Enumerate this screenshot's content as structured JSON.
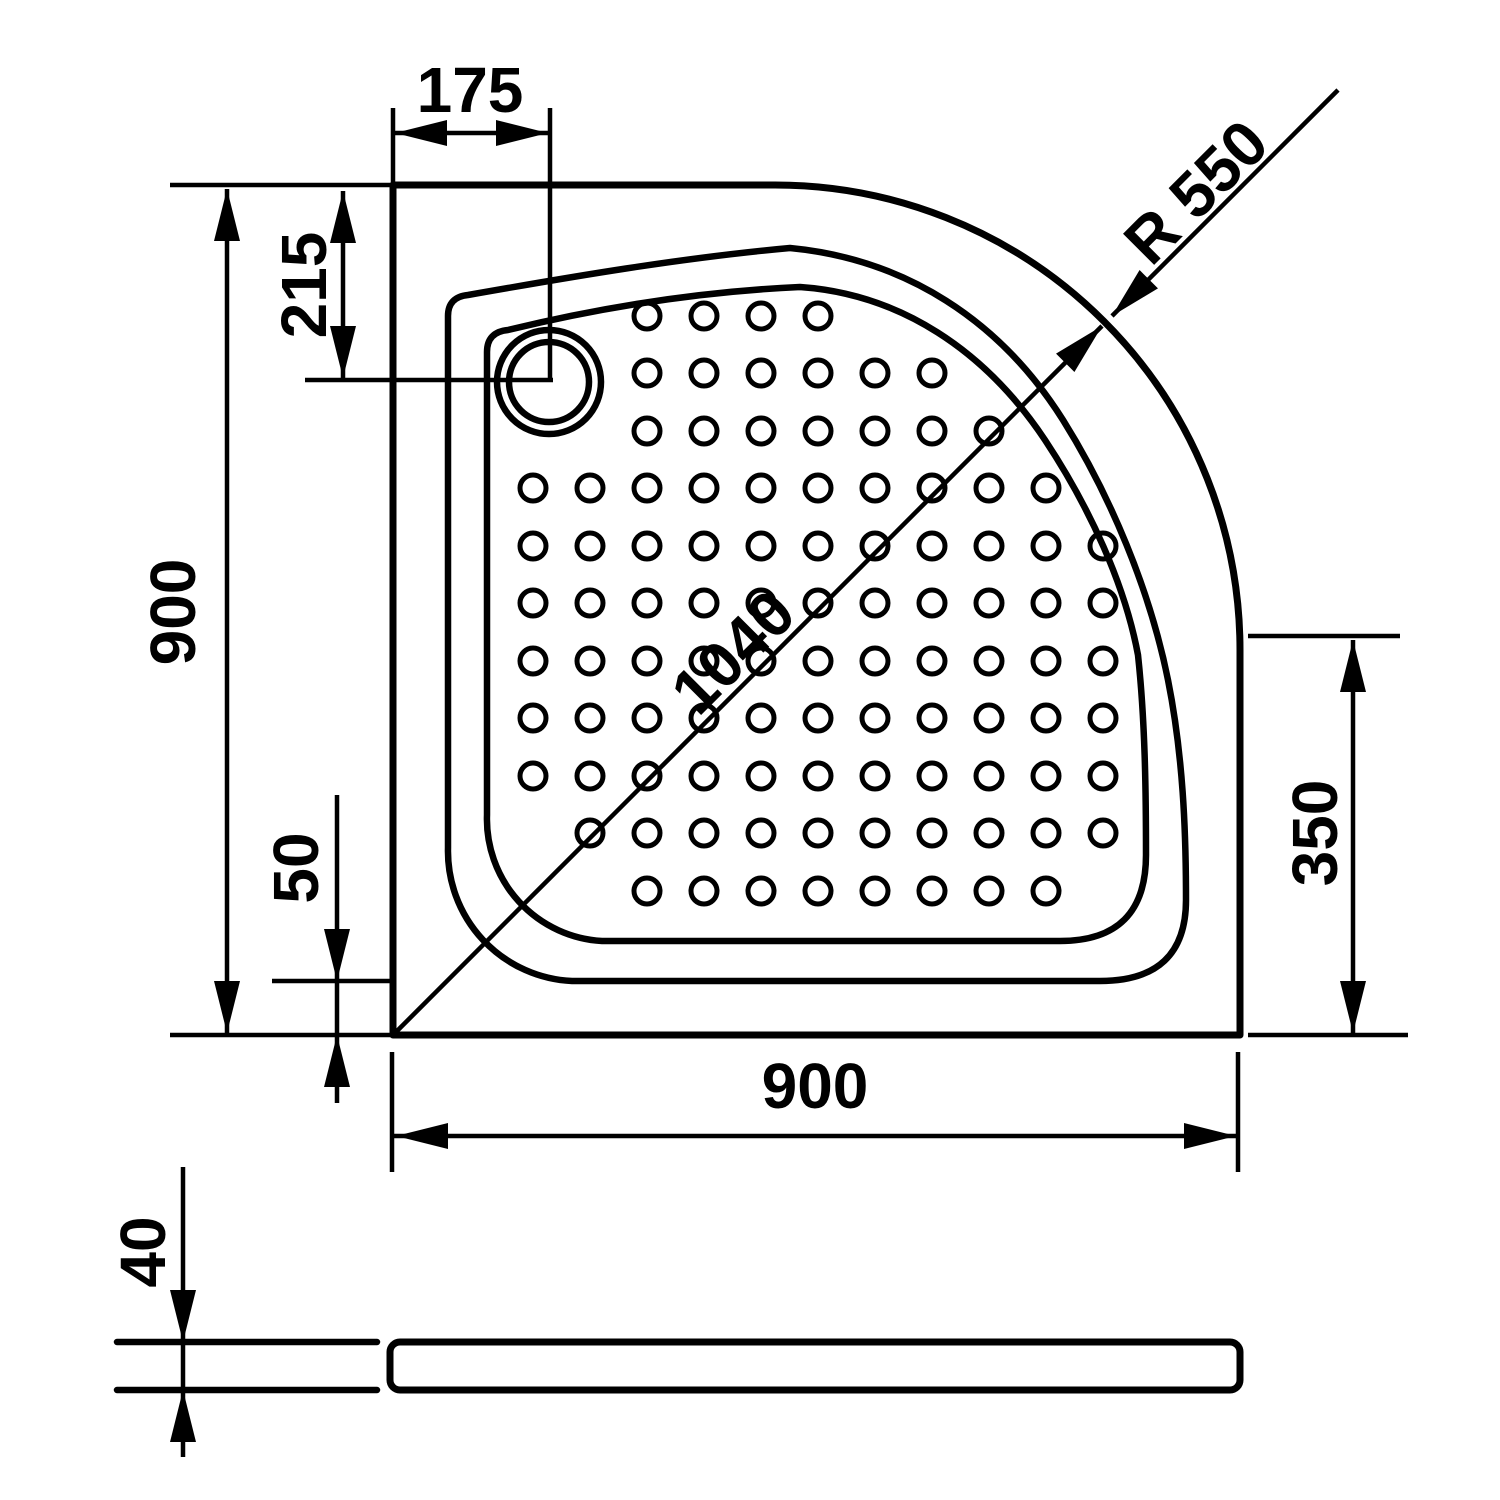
{
  "colors": {
    "line": "#000000",
    "background": "#ffffff"
  },
  "dimension_labels": {
    "drain_offset_x": "175",
    "drain_offset_y": "215",
    "side_left": "900",
    "rim_inset": "50",
    "side_bottom": "900",
    "right_straight": "350",
    "thickness": "40",
    "diagonal": "1040",
    "corner_radius": "R 550"
  },
  "drain": {
    "cx": 549,
    "cy": 382,
    "outer_r": 52,
    "inner_r": 40
  },
  "dot_grid": {
    "dot_radius": 13,
    "dot_stroke": 5,
    "columns_x": [
      533,
      590,
      647,
      704,
      761,
      818,
      875,
      932,
      989,
      1046,
      1103
    ],
    "rows": [
      {
        "y": 316,
        "from": 2,
        "to": 5
      },
      {
        "y": 373,
        "from": 2,
        "to": 7
      },
      {
        "y": 431,
        "from": 2,
        "to": 8
      },
      {
        "y": 488,
        "from": 0,
        "to": 9
      },
      {
        "y": 546,
        "from": 0,
        "to": 10
      },
      {
        "y": 603,
        "from": 0,
        "to": 10
      },
      {
        "y": 661,
        "from": 0,
        "to": 10
      },
      {
        "y": 718,
        "from": 0,
        "to": 10
      },
      {
        "y": 776,
        "from": 0,
        "to": 10
      },
      {
        "y": 833,
        "from": 1,
        "to": 10
      },
      {
        "y": 891,
        "from": 2,
        "to": 9
      }
    ]
  }
}
